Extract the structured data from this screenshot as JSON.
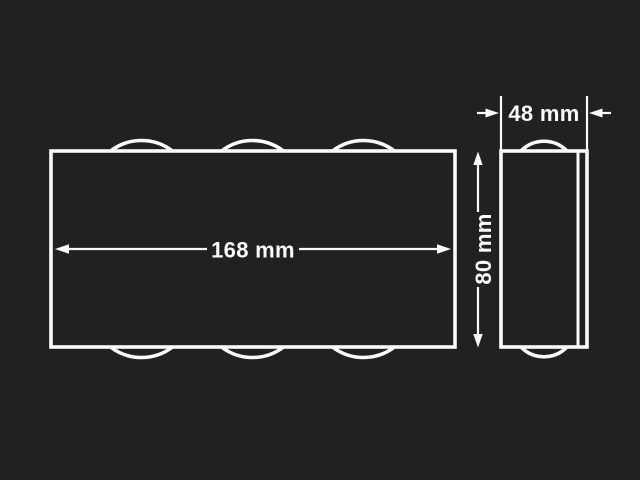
{
  "colors": {
    "background": "#212121",
    "line": "#fafafa"
  },
  "front_view": {
    "width_label": "168 mm",
    "width_mm": 168,
    "lens_arcs_top": 3,
    "lens_arcs_bottom": 3
  },
  "side_view": {
    "depth_label": "48 mm",
    "depth_mm": 48,
    "height_label": "80 mm",
    "height_mm": 80,
    "lens_arcs_top": 1,
    "lens_arcs_bottom": 1
  }
}
